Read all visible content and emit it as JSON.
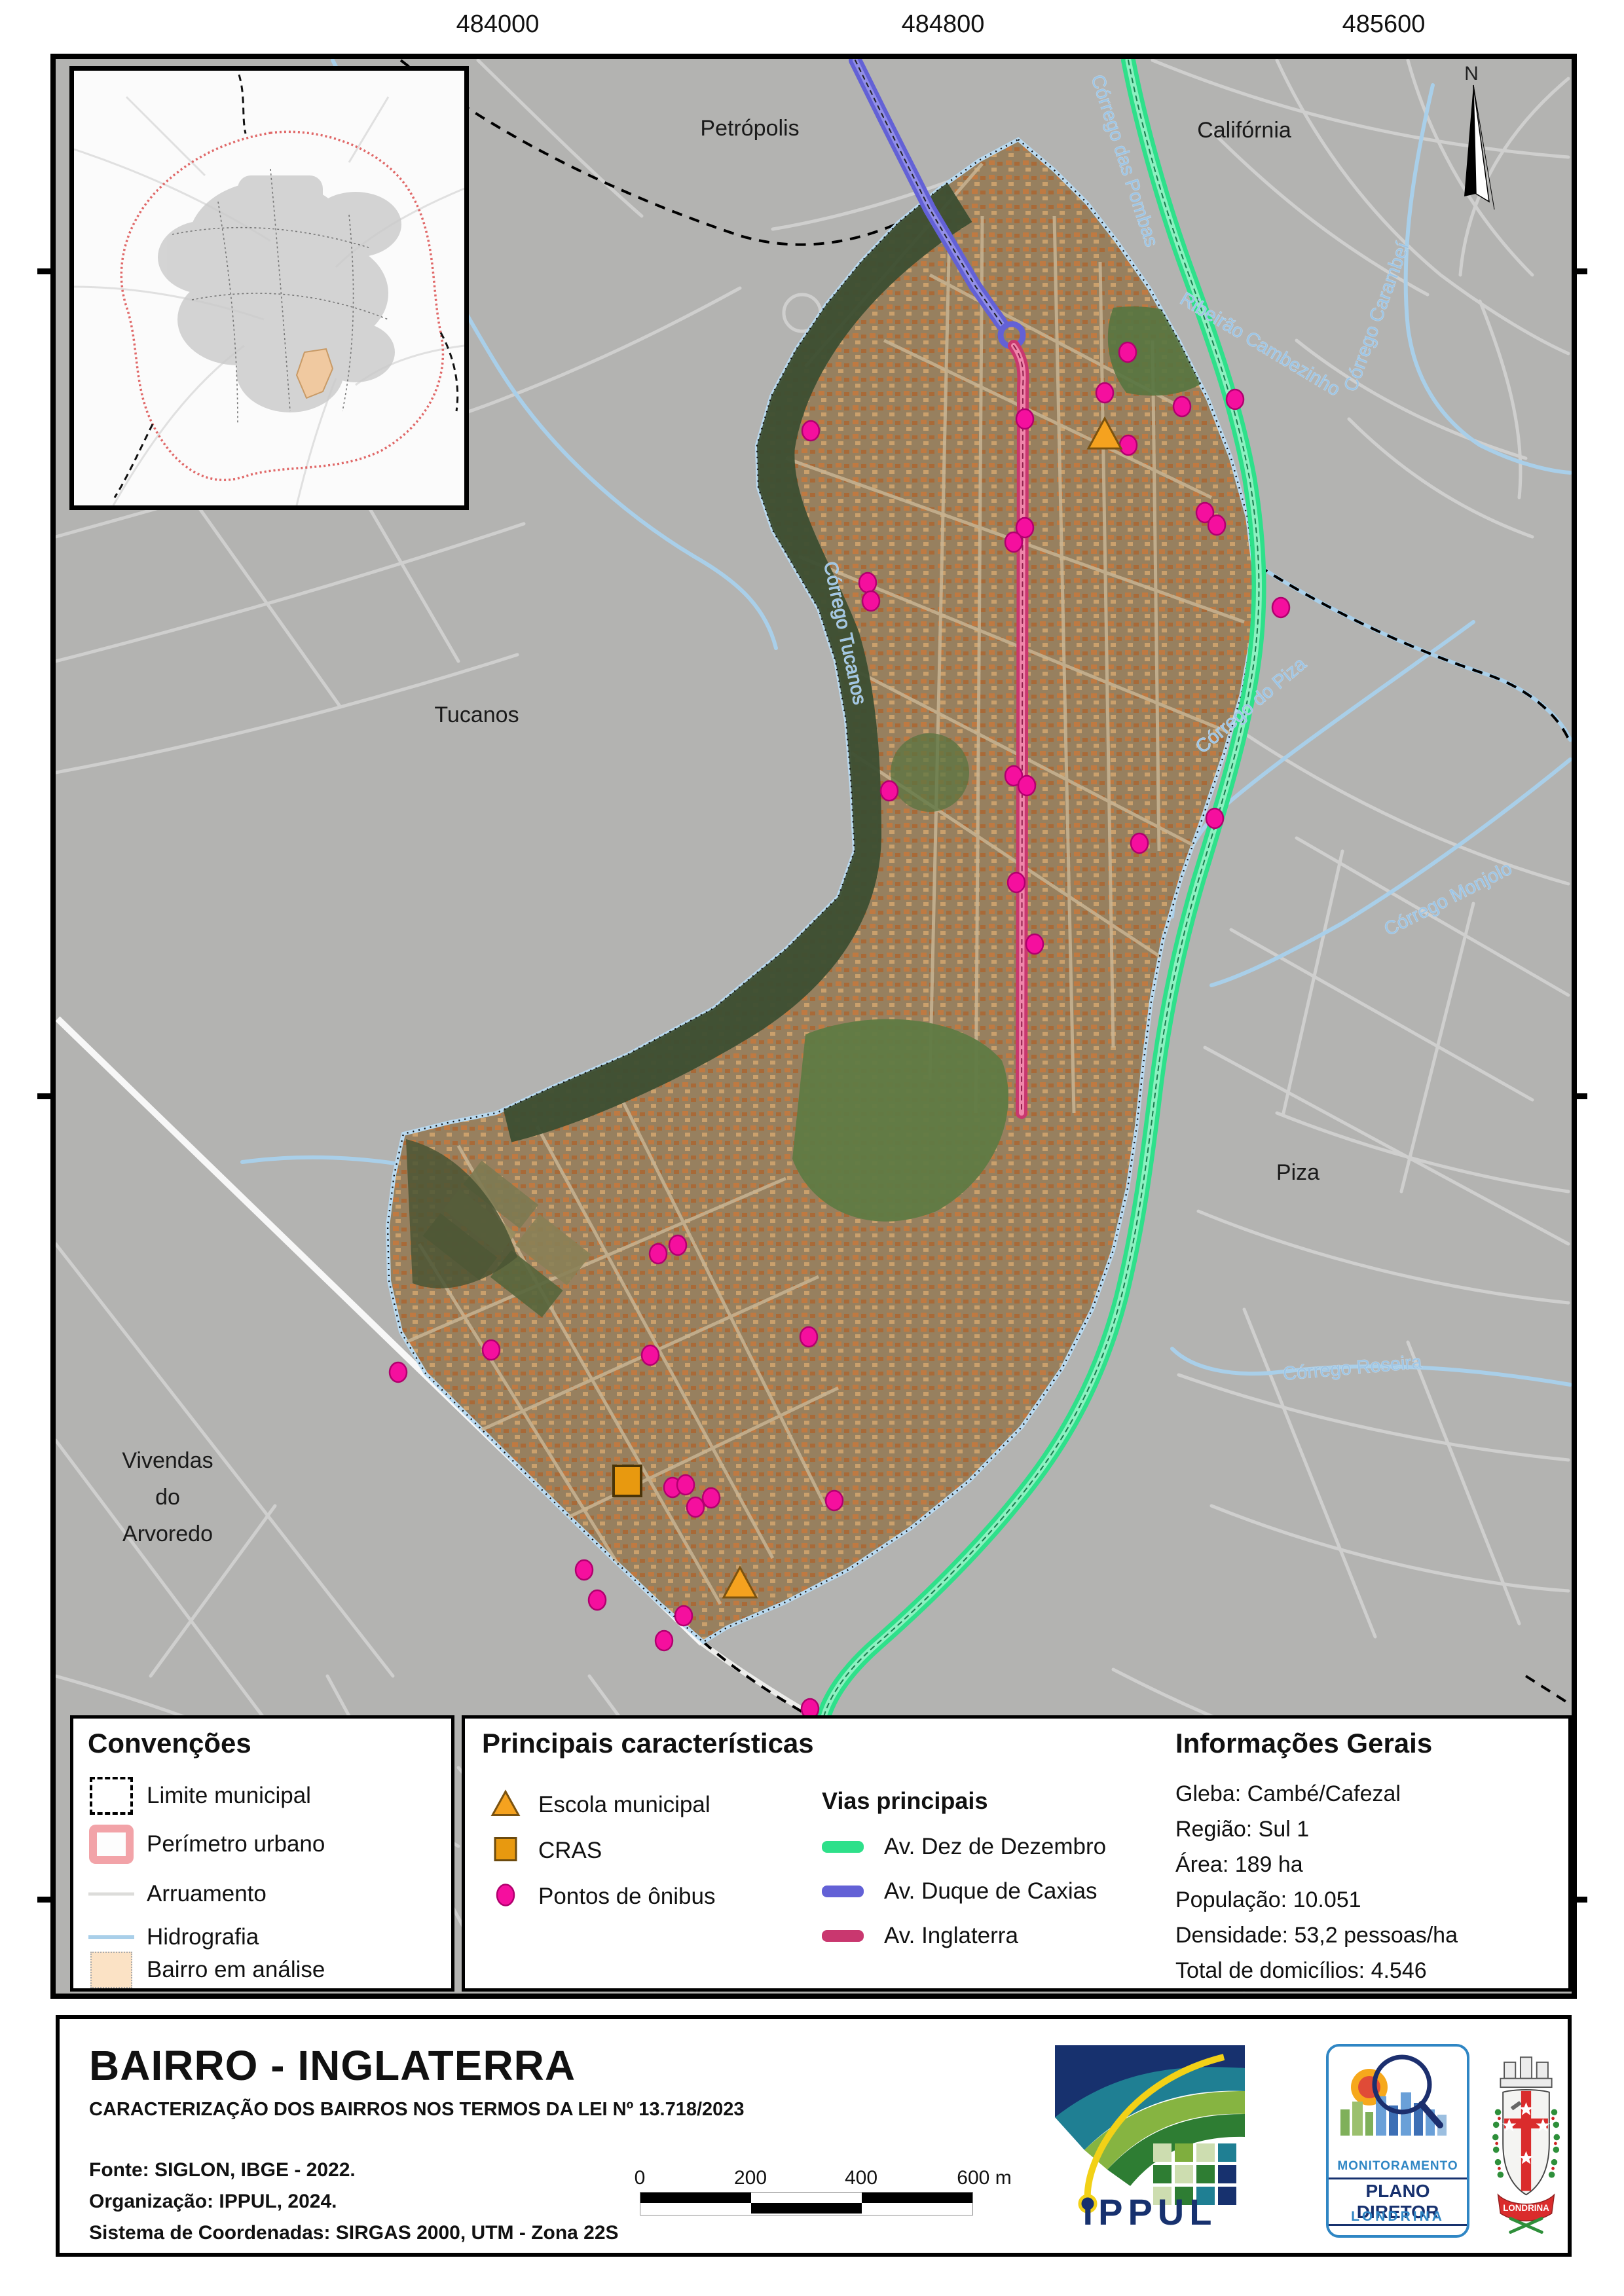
{
  "map": {
    "top_coords": [
      "484000",
      "484800",
      "485600"
    ],
    "right_coords": [
      "7419000",
      "7417500",
      "7416000"
    ],
    "north_label": "N",
    "labels": {
      "petropolis": "Petrópolis",
      "california": "Califórnia",
      "tucanos": "Tucanos",
      "piza": "Piza",
      "vivendas_l1": "Vivendas",
      "vivendas_l2": "do",
      "vivendas_l3": "Arvoredo"
    },
    "streams": {
      "tucanos": "Córrego Tucanos",
      "pombas": "Córrego das Pombas",
      "cambezinho": "Ribeirão Cambezinho",
      "carambei": "Córrego Carambeí",
      "piza": "Córrego do Piza",
      "monjolo": "Córrego Monjolo",
      "roseira": "Córrego Roseira"
    }
  },
  "map_points": {
    "bus_stops": [
      [
        1722,
        538
      ],
      [
        1687,
        600
      ],
      [
        1805,
        621
      ],
      [
        1886,
        610
      ],
      [
        1565,
        640
      ],
      [
        1238,
        658
      ],
      [
        1723,
        680
      ],
      [
        1840,
        783
      ],
      [
        1858,
        802
      ],
      [
        1565,
        806
      ],
      [
        1548,
        828
      ],
      [
        1325,
        890
      ],
      [
        1330,
        918
      ],
      [
        1956,
        928
      ],
      [
        1548,
        1185
      ],
      [
        1568,
        1200
      ],
      [
        1358,
        1208
      ],
      [
        1855,
        1250
      ],
      [
        1740,
        1288
      ],
      [
        1552,
        1348
      ],
      [
        1580,
        1442
      ],
      [
        1005,
        1915
      ],
      [
        1035,
        1902
      ],
      [
        993,
        2070
      ],
      [
        1235,
        2042
      ],
      [
        608,
        2096
      ],
      [
        750,
        2062
      ],
      [
        1027,
        2272
      ],
      [
        1047,
        2268
      ],
      [
        1086,
        2288
      ],
      [
        1062,
        2302
      ],
      [
        1274,
        2292
      ],
      [
        892,
        2398
      ],
      [
        912,
        2444
      ],
      [
        1044,
        2468
      ],
      [
        1014,
        2506
      ],
      [
        1237,
        2610
      ]
    ],
    "schools": [
      [
        1687,
        665
      ],
      [
        1130,
        2420
      ]
    ],
    "cras": [
      [
        958,
        2262
      ]
    ]
  },
  "legend": {
    "conventions": {
      "title": "Convenções",
      "items": [
        {
          "label": "Limite municipal",
          "icon": "dashed-square-swatch"
        },
        {
          "label": "Perímetro urbano",
          "icon": "pink-border-square-swatch"
        },
        {
          "label": "Arruamento",
          "icon": "gray-line-swatch"
        },
        {
          "label": "Hidrografia",
          "icon": "blue-line-swatch"
        },
        {
          "label": "Bairro em análise",
          "icon": "peach-fill-swatch"
        }
      ]
    },
    "characteristics": {
      "title": "Principais características",
      "markers": [
        {
          "label": "Escola municipal",
          "icon": "orange-triangle-icon"
        },
        {
          "label": "CRAS",
          "icon": "orange-square-icon"
        },
        {
          "label": "Pontos de ônibus",
          "icon": "magenta-dot-icon"
        }
      ],
      "vias_title": "Vias principais",
      "vias": [
        {
          "label": "Av. Dez de Dezembro"
        },
        {
          "label": "Av. Duque de Caxias"
        },
        {
          "label": "Av. Inglaterra"
        }
      ]
    },
    "info": {
      "title": "Informações Gerais",
      "lines": [
        "Gleba: Cambé/Cafezal",
        "Região: Sul 1",
        "Área: 189 ha",
        "População: 10.051",
        "Densidade: 53,2 pessoas/ha",
        "Total de domicílios: 4.546"
      ]
    }
  },
  "titleblock": {
    "title": "BAIRRO - INGLATERRA",
    "subtitle": "CARACTERIZAÇÃO DOS BAIRROS NOS TERMOS DA LEI Nº 13.718/2023",
    "source_lines": [
      "Fonte: SIGLON, IBGE - 2022.",
      "Organização: IPPUL, 2024.",
      "Sistema de Coordenadas: SIRGAS 2000, UTM - Zona 22S"
    ],
    "scalebar_labels": [
      "0",
      "200",
      "400",
      "600 m"
    ],
    "logos": {
      "ippul": "IPPUL",
      "monit_line1": "MONITORAMENTO",
      "monit_line2": "PLANO DIRETOR",
      "monit_line3": "LONDRINA",
      "brasao": "LONDRINA"
    }
  },
  "colors": {
    "av_dez_de_dezembro": "#2ee08a",
    "av_duque_de_caxias": "#6361d6",
    "av_inglaterra": "#c9376f",
    "bus_stop": "#f50f9e",
    "school": "#f5a21f",
    "cras": "#e8990f",
    "hydrography": "#a9cfe9",
    "urban_perimeter": "#f2a3a8",
    "bairro_highlight": "#fbe2c5",
    "municipal_limit": "#000000",
    "road": "#cfcfce",
    "map_background": "#b3b3b1"
  }
}
